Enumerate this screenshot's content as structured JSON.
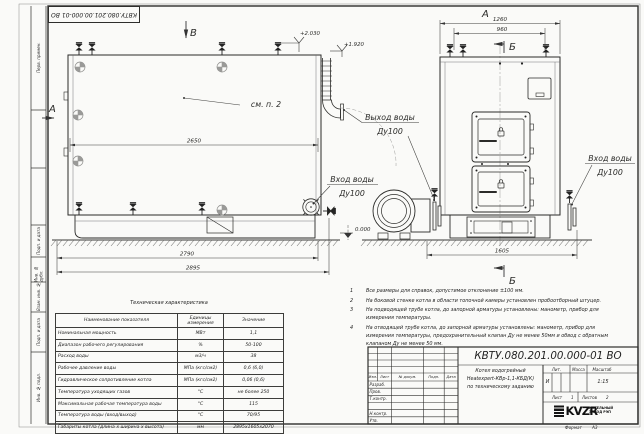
{
  "title_block": {
    "doc_number": "КВТУ.080.201.00.000-01 ВО",
    "product_name": [
      "Котел водогрейный",
      "Heatexpert-КВр-1,1-КБД(К)",
      "по техническому заданию"
    ],
    "columns": [
      "Изм.",
      "Лист",
      "№ докум.",
      "Подп.",
      "Дата"
    ],
    "staff": [
      "Разраб.",
      "Пров.",
      "Т.контр.",
      "Н.контр.",
      "Утв."
    ],
    "lit_header": "Лит.",
    "mass_header": "Масса",
    "scale_header": "Масштаб",
    "lit": "И",
    "scale": "1:15",
    "sheet_label": "Лист",
    "sheet_num": "1",
    "sheets_label": "Листов",
    "sheets_num": "2",
    "logo_text": "KVZR",
    "company": [
      "КОТЕЛЬНЫЙ",
      "ЗАВОД РЭП"
    ],
    "format_label": "Формат",
    "format_value": "А3"
  },
  "margin_fields": [
    "Перв. примен.",
    "Подп. и дата",
    "Инв. № дубл.",
    "Взам. инв. №",
    "Подп. и дата",
    "Инв. № подл."
  ],
  "views": {
    "section_v_top": "В",
    "section_a_side": "А",
    "view_a_label": "А",
    "section_b_top": "Б",
    "section_b_bottom": "Б",
    "see_note": "см. п. 2",
    "labels": {
      "outlet": [
        "Выход воды",
        "Ду100"
      ],
      "inlet_side": [
        "Вход воды",
        "Ду100"
      ],
      "inlet_front": [
        "Вход воды",
        "Ду100"
      ]
    },
    "elevations": {
      "top": "+2.030",
      "outlet": "+1.920",
      "ground": "0.000"
    },
    "dims": {
      "side_inner": "2650",
      "side_base": "2790",
      "side_overall": "2895",
      "front_overall": "1260",
      "front_inner": "960",
      "front_base": "1605"
    }
  },
  "notes": [
    {
      "n": "1",
      "t": "Все размеры для справок, допустимое отклонение ±100 мм."
    },
    {
      "n": "2",
      "t": "На боковой стенке котла в области топочной камеры установлен пробоотборный штуцер."
    },
    {
      "n": "3",
      "t": "На подводящей трубе котла, до запорной арматуры установлены: манометр, прибор для измерения температуры."
    },
    {
      "n": "4",
      "t": "На отводящей трубе котла, до запорной арматуры установлены: манометр, прибор для измерения температуры, предохранительный клапан Ду не менее 50мм и обвод с обратным клапаном Ду не менее 50 мм."
    }
  ],
  "tech_table": {
    "title": "Техническая характеристика",
    "headers": [
      "Наименование показателя",
      "Единицы измерения",
      "Значение"
    ],
    "rows": [
      [
        "Номинальная мощность",
        "МВт",
        "1,1"
      ],
      [
        "Диапазон рабочего регулирования",
        "%",
        "50-100"
      ],
      [
        "Расход воды",
        "м3/ч",
        "38"
      ],
      [
        "Рабочее давление воды",
        "МПа (кгс/см2)",
        "0,6 (6,0)"
      ],
      [
        "Гидравлическое сопротивление котла",
        "МПа (кгс/см2)",
        "0,06 (0,6)"
      ],
      [
        "Температура уходящих газов",
        "°С",
        "не более 250"
      ],
      [
        "Максимальная рабочая температура воды",
        "°С",
        "115"
      ],
      [
        "Температура воды (вход/выход)",
        "°С",
        "70/95"
      ],
      [
        "Габариты котла (длина х ширина х высота)",
        "мм",
        "2895х1605х2070"
      ]
    ]
  }
}
